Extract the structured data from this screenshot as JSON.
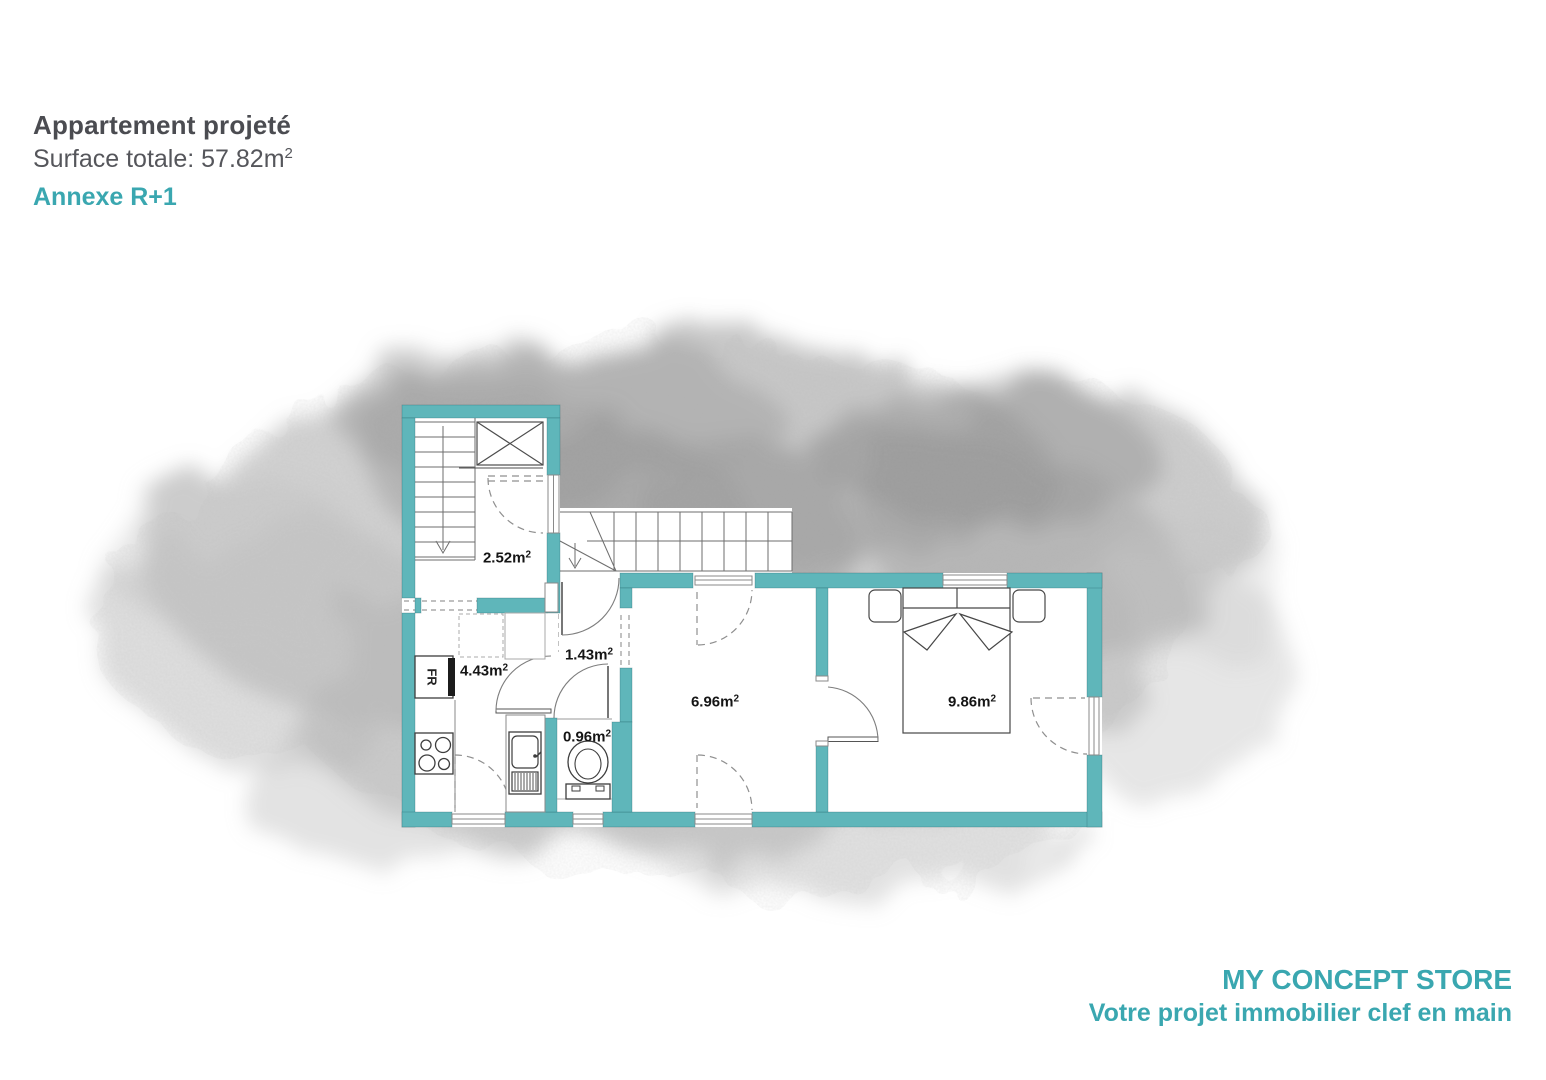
{
  "header": {
    "title": "Appartement projeté",
    "surface": "Surface totale: 57.82m",
    "surface_sup": "2",
    "annex": "Annexe R+1"
  },
  "footer": {
    "brand": "MY CONCEPT STORE",
    "tagline": "Votre projet immobilier clef en main"
  },
  "plan": {
    "sup": "2",
    "fridge_label": "FR",
    "rooms": {
      "landing": {
        "area": "2.52m"
      },
      "kitchen": {
        "area": "4.43m"
      },
      "hall": {
        "area": "1.43m"
      },
      "wc": {
        "area": "0.96m"
      },
      "room": {
        "area": "6.96m"
      },
      "bedroom": {
        "area": "9.86m"
      }
    }
  },
  "colors": {
    "wall": "#5fb6ba",
    "teal-text": "#3aa7b0",
    "title": "#4b4c51",
    "subtitle": "#55565b",
    "label": "#151515"
  }
}
